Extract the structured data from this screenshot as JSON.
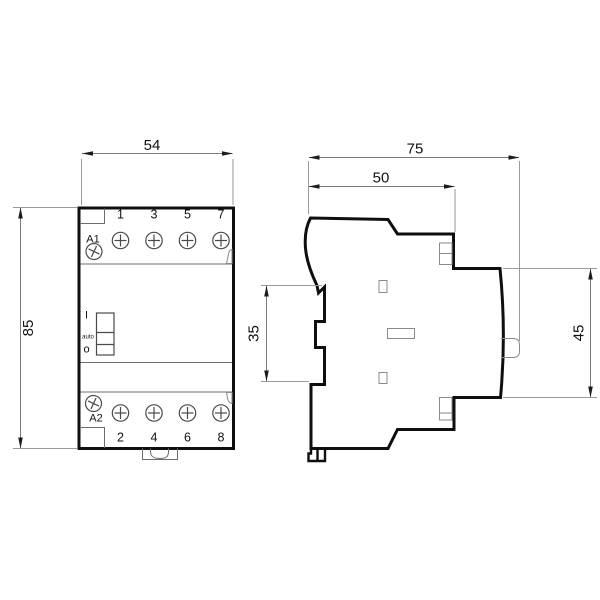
{
  "title": "Modular contactor dimension drawing",
  "front_view": {
    "terminals_top": [
      "1",
      "3",
      "5",
      "7"
    ],
    "terminals_bottom": [
      "2",
      "4",
      "6",
      "8"
    ],
    "coil_terminal_top": "A1",
    "coil_terminal_bottom": "A2",
    "switch_positions": [
      "I",
      "auto",
      "o"
    ]
  },
  "dimensions": {
    "front_width": "54",
    "front_height": "85",
    "side_depth_total": "75",
    "side_depth_upper": "50",
    "din_rail_height": "35",
    "side_back_height": "45"
  },
  "colors": {
    "outline": "#0f0f0f",
    "thin_line": "#6e6e6e",
    "detail_line": "#8a8a8a",
    "dimension_line": "#7a7a7a",
    "text": "#111111",
    "background": "#ffffff"
  }
}
